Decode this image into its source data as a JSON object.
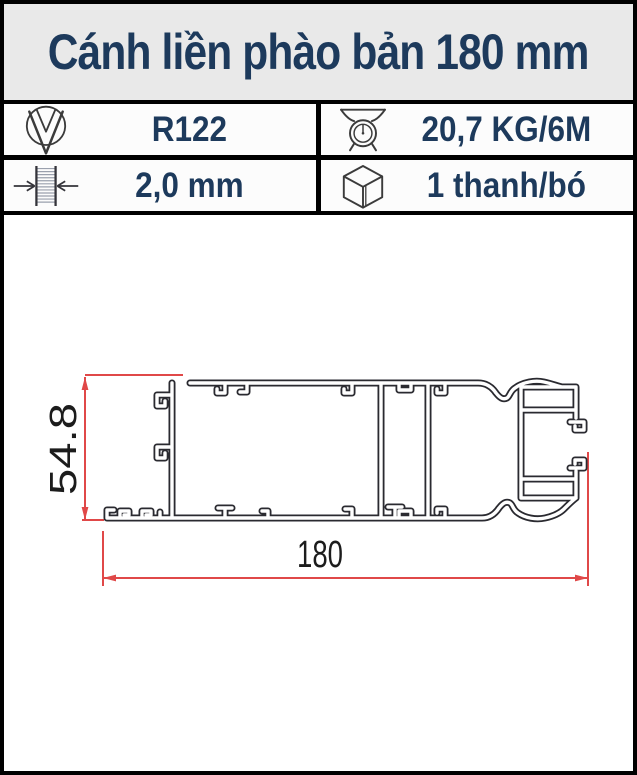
{
  "window": {
    "title": "Cánh liền phào bản 180 mm"
  },
  "specs": [
    {
      "id": "code",
      "icon": "brand-v-logo-icon",
      "value": "R122"
    },
    {
      "id": "weight",
      "icon": "scale-icon",
      "value": "20,7 KG/6M"
    },
    {
      "id": "thickness",
      "icon": "thickness-icon",
      "value": "2,0 mm"
    },
    {
      "id": "packing",
      "icon": "cube-icon",
      "value": "1 thanh/bó"
    }
  ],
  "drawing": {
    "type": "aluminium-profile-cross-section",
    "height_dim": "54.8",
    "width_dim": "180"
  },
  "colors": {
    "navy_text": "#1d3a5c",
    "header_bg": "#e9e9e9",
    "border": "#000000",
    "dimension_red": "#e04848",
    "profile_line": "#2a2a30"
  }
}
